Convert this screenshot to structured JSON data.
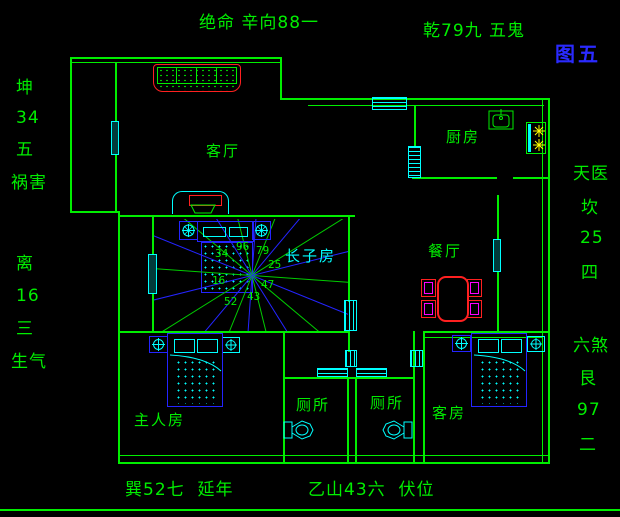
{
  "figure_label": "图五",
  "annotations": {
    "top": "绝命 辛向88一",
    "top_right": "乾79九 五鬼",
    "bottom_left": "巽52七  延年",
    "bottom_center": "乙山43六  伏位",
    "left_column": [
      "坤",
      "34",
      "五",
      "祸害",
      "离",
      "16",
      "三",
      "生气"
    ],
    "right_column": [
      "天医",
      "坎",
      "25",
      "四",
      "六煞",
      "艮",
      "97",
      "二"
    ]
  },
  "rooms": {
    "living": "客厅",
    "kitchen": "厨房",
    "dining": "餐厅",
    "eldest_son": "长子房",
    "master": "主人房",
    "toilet_left": "厕所",
    "toilet_right": "厕所",
    "guest": "客房"
  },
  "compass_numbers": {
    "n": "96",
    "ne": "79",
    "e": "25",
    "se": "47",
    "s": "43",
    "sw": "52",
    "w": "16",
    "nw": "34"
  },
  "colors": {
    "wall_green": "#00ee00",
    "cyan": "#00ffff",
    "blue": "#2424ff",
    "red": "#ff2020",
    "magenta": "#ff00ff",
    "yellow": "#ffff00",
    "figure_label_blue": "#2a2aff"
  }
}
